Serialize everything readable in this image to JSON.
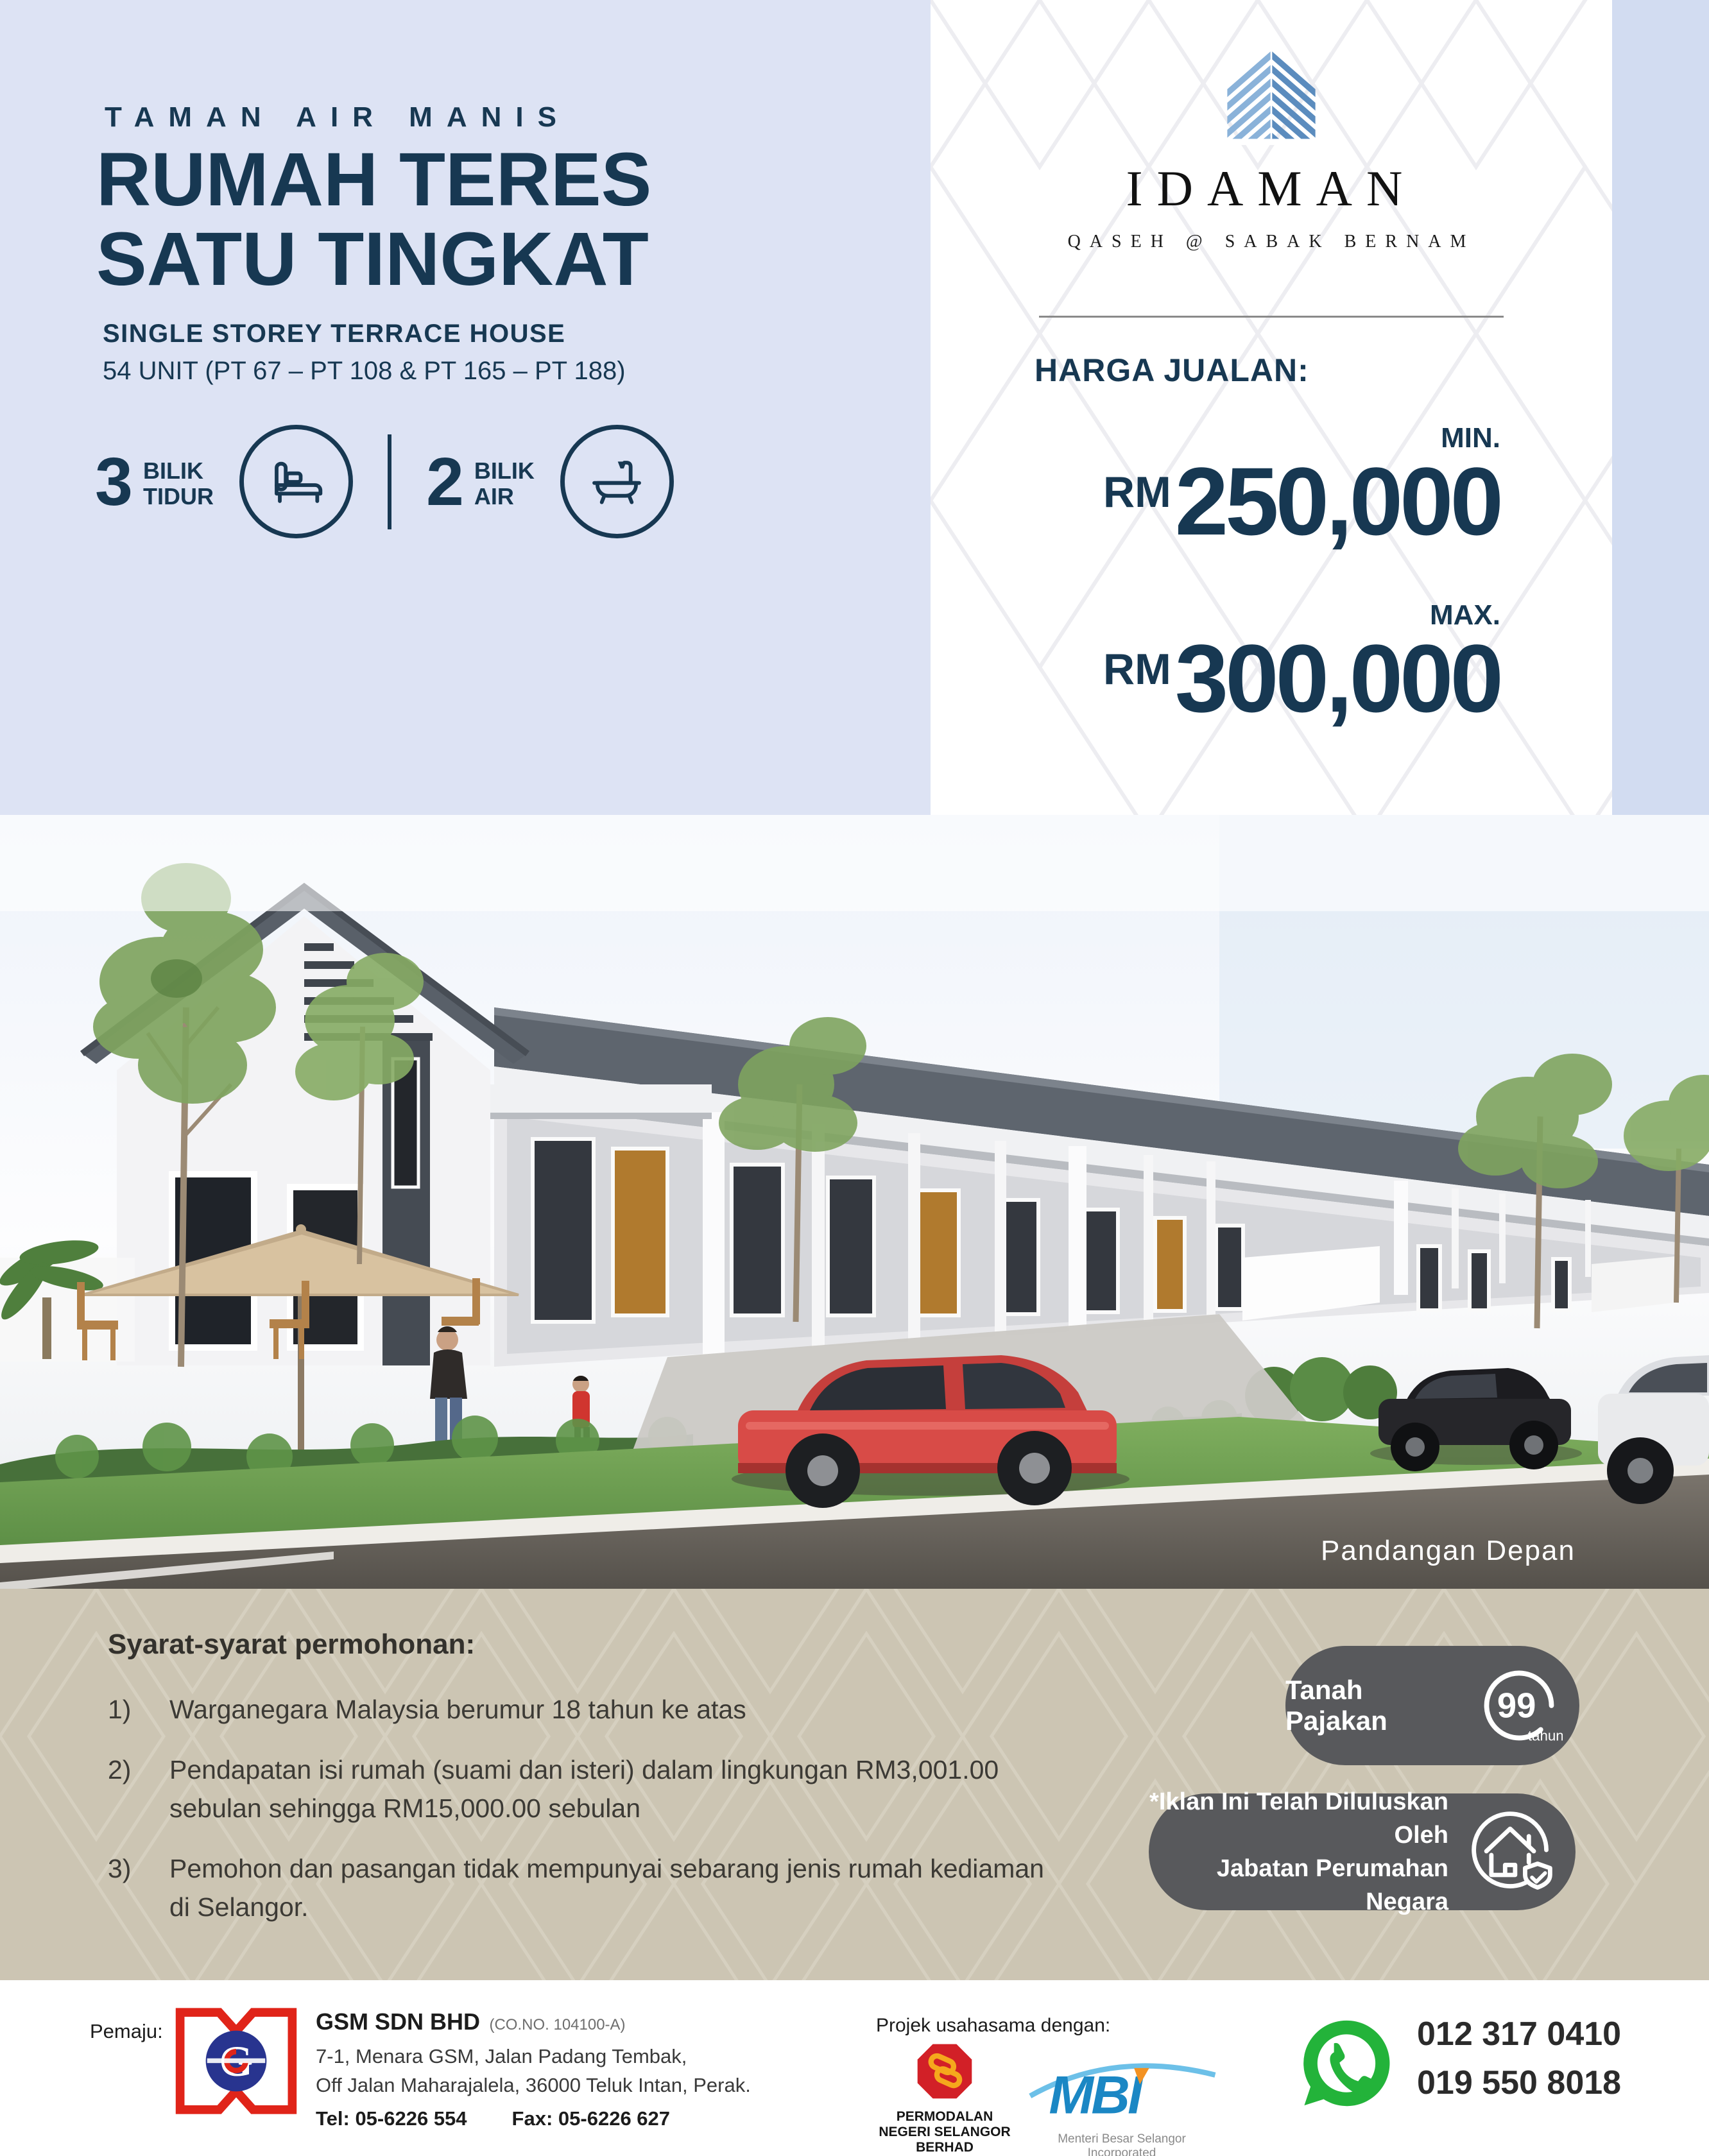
{
  "colors": {
    "navy": "#173852",
    "top_left_bg": "#dde3f4",
    "right_strip_bg": "#d2dcf1",
    "beige": "#ccc5b3",
    "badge_gray": "#58595c",
    "whatsapp_green": "#23b33a",
    "brand_blue_light": "#8ab2d9",
    "brand_blue_dark": "#5b8cbe"
  },
  "header": {
    "estate_name": "TAMAN AIR MANIS",
    "title_line1": "RUMAH TERES",
    "title_line2": "SATU TINGKAT",
    "subtitle": "SINGLE STOREY TERRACE HOUSE",
    "units": "54 UNIT (PT 67 – PT 108 & PT 165 – PT 188)",
    "features": [
      {
        "count": "3",
        "label_line1": "BILIK",
        "label_line2": "TIDUR",
        "icon": "bed-icon"
      },
      {
        "count": "2",
        "label_line1": "BILIK",
        "label_line2": "AIR",
        "icon": "bath-icon"
      }
    ]
  },
  "brand": {
    "name": "IDAMAN",
    "tagline": "QASEH @ SABAK BERNAM",
    "logo_icon": "chevron-house-icon"
  },
  "pricing": {
    "heading": "HARGA JUALAN:",
    "min_label": "MIN.",
    "min_currency": "RM",
    "min_value": "250,000",
    "max_label": "MAX.",
    "max_currency": "RM",
    "max_value": "300,000"
  },
  "render": {
    "caption": "Pandangan Depan"
  },
  "terms": {
    "heading": "Syarat-syarat permohonan:",
    "items": [
      {
        "num": "1)",
        "text": "Warganegara Malaysia berumur 18 tahun ke atas"
      },
      {
        "num": "2)",
        "text": "Pendapatan isi rumah (suami dan isteri) dalam lingkungan RM3,001.00 sebulan sehingga RM15,000.00 sebulan"
      },
      {
        "num": "3)",
        "text": "Pemohon dan pasangan tidak mempunyai sebarang jenis rumah kediaman di Selangor."
      }
    ]
  },
  "badges": {
    "leasehold": {
      "label": "Tanah Pajakan",
      "value": "99",
      "unit": "tahun",
      "icon": "99-years-circle-icon"
    },
    "approval": {
      "line1": "*Iklan Ini Telah Diluluskan Oleh",
      "line2": "Jabatan Perumahan Negara",
      "icon": "house-shield-icon"
    }
  },
  "footer": {
    "developer_label": "Pemaju:",
    "developer": {
      "name": "GSM SDN BHD",
      "co_no": "(CO.NO. 104100-A)",
      "address_line1": "7-1, Menara GSM, Jalan Padang Tembak,",
      "address_line2": "Off Jalan Maharajalela, 36000 Teluk Intan, Perak.",
      "tel_label": "Tel:",
      "tel": "05-6226 554",
      "fax_label": "Fax:",
      "fax": "05-6226 627"
    },
    "partners_label": "Projek usahasama dengan:",
    "pnsb": {
      "name_line1": "PERMODALAN",
      "name_line2": "NEGERI SELANGOR BERHAD",
      "reg": "199001014678 (206347-V)",
      "icon": "pnsb-logo"
    },
    "mbi": {
      "name": "MBI",
      "tagline": "Menteri Besar Selangor Incorporated",
      "icon": "mbi-logo"
    },
    "contact": {
      "icon": "whatsapp-icon",
      "phone1": "012 317 0410",
      "phone2": "019 550 8018"
    }
  }
}
